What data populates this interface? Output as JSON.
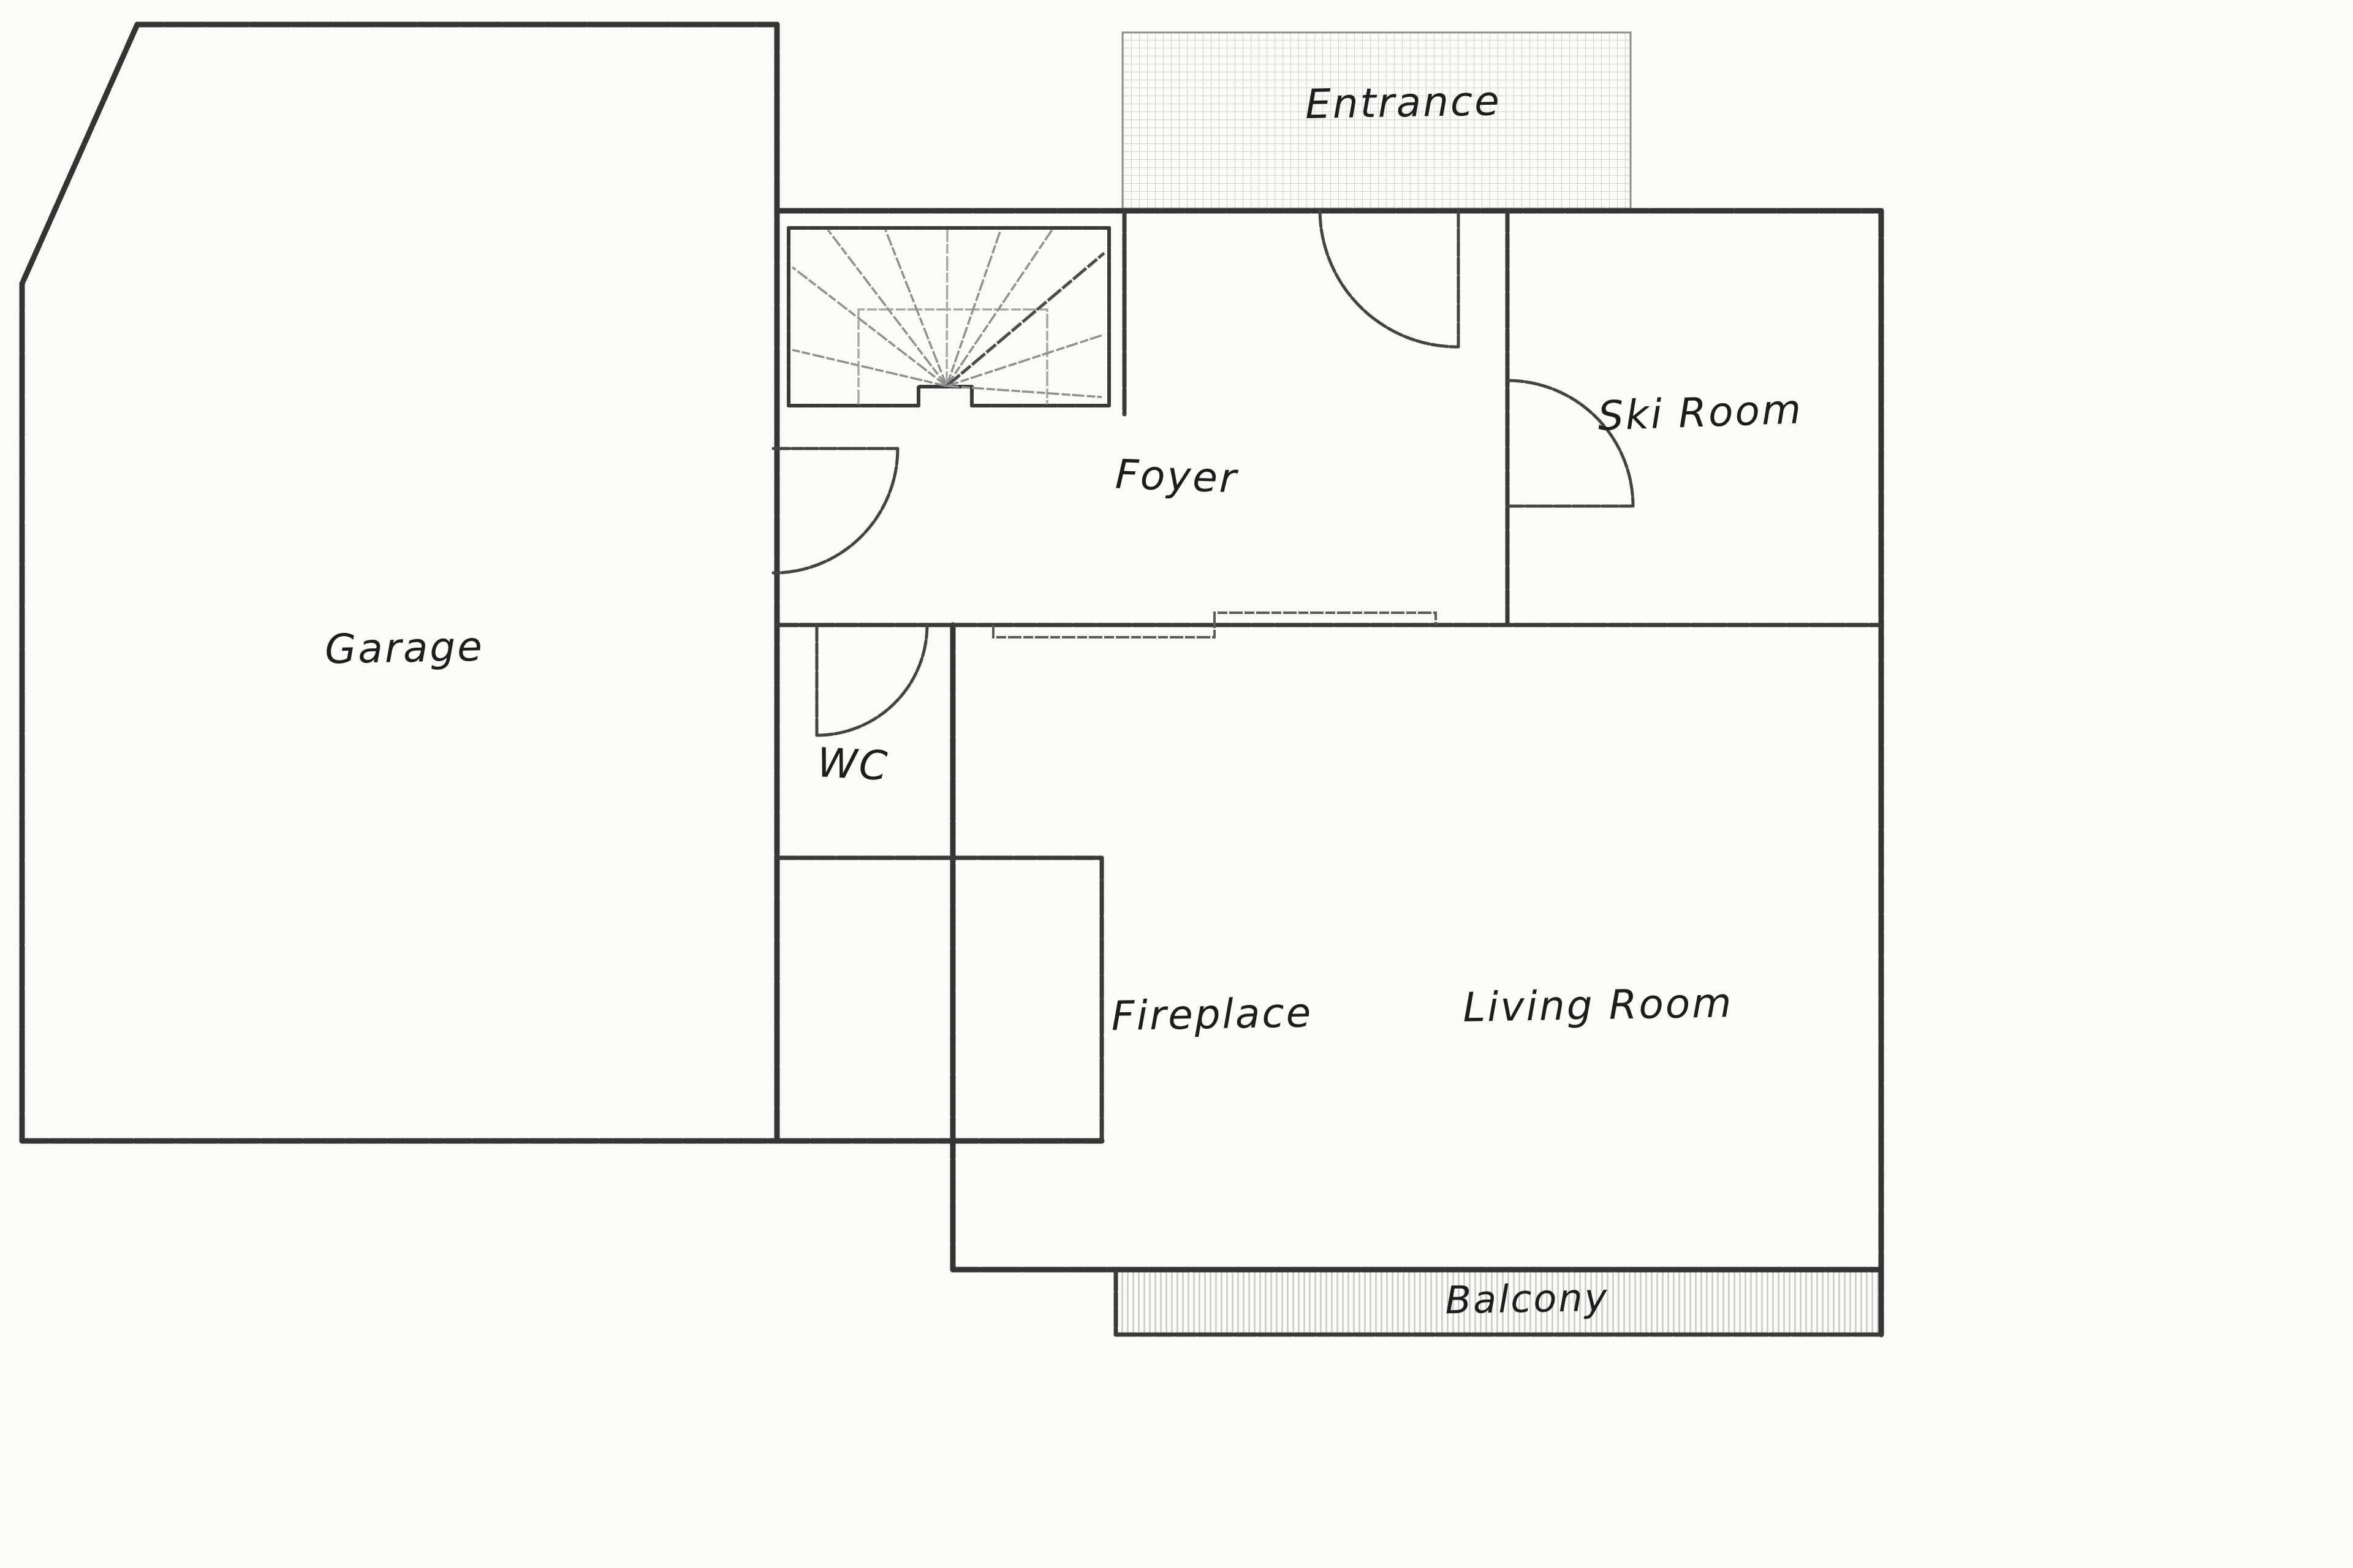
{
  "document": {
    "type": "hand-drawn floor plan",
    "floor": "ground floor"
  },
  "labels": {
    "entrance": "Entrance",
    "foyer": "Foyer",
    "ski_room": "Ski Room",
    "garage": "Garage",
    "wc": "WC",
    "fireplace": "Fireplace",
    "living_room": "Living Room",
    "balcony": "Balcony"
  },
  "colors": {
    "paper": "#fbfbf8",
    "ink": "#343434",
    "label_ink": "#1d1d1d",
    "entrance_grid_hatch": "#cccccc",
    "balcony_line_hatch": "#c7c7c7",
    "stair_fan_light": "#8f8f8f"
  }
}
